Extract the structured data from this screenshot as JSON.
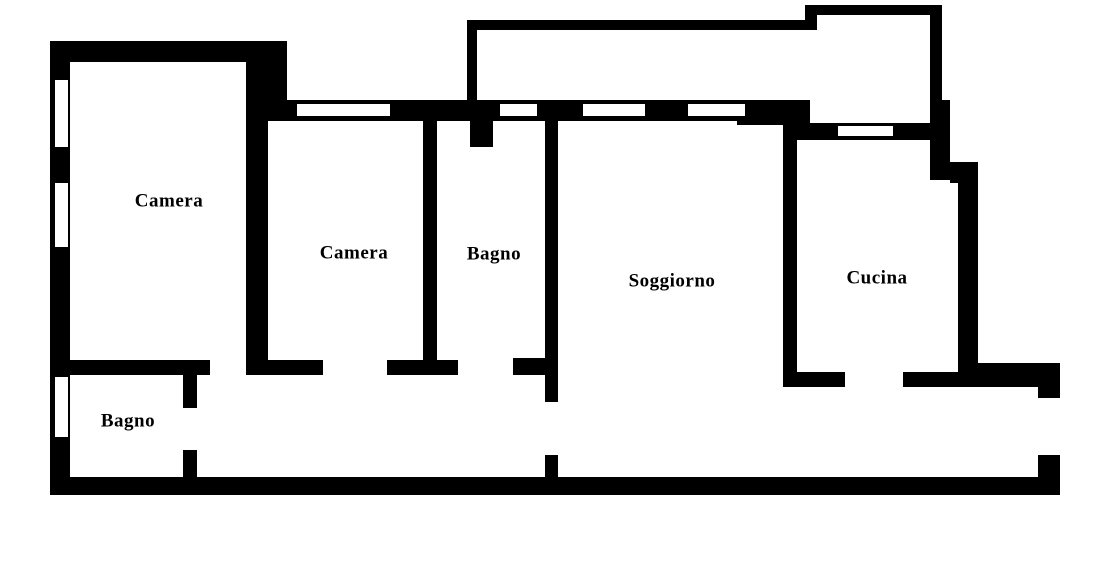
{
  "plan": {
    "title": "Apartment floor plan",
    "width": 1112,
    "height": 561,
    "background_color": "#ffffff",
    "wall_color": "#000000",
    "walls": [
      {
        "name": "exterior-left-wall",
        "x": 50,
        "y": 41,
        "w": 20,
        "h": 454
      },
      {
        "name": "camera1-top-wall",
        "x": 50,
        "y": 41,
        "w": 218,
        "h": 21
      },
      {
        "name": "camera1-top-right-corner-block",
        "x": 258,
        "y": 41,
        "w": 29,
        "h": 80
      },
      {
        "name": "wall-camera1-camera2",
        "x": 246,
        "y": 41,
        "w": 22,
        "h": 334
      },
      {
        "name": "north-window-band",
        "x": 268,
        "y": 100,
        "w": 542,
        "h": 21
      },
      {
        "name": "north-band-thick-block",
        "x": 737,
        "y": 100,
        "w": 73,
        "h": 25
      },
      {
        "name": "balcony-left-wall",
        "x": 467,
        "y": 20,
        "w": 10,
        "h": 81
      },
      {
        "name": "balcony-top-wall",
        "x": 467,
        "y": 20,
        "w": 350,
        "h": 10
      },
      {
        "name": "balcony-box-left-wall",
        "x": 805,
        "y": 5,
        "w": 12,
        "h": 25
      },
      {
        "name": "balcony-box-top-wall",
        "x": 805,
        "y": 5,
        "w": 137,
        "h": 10
      },
      {
        "name": "balcony-box-right-wall",
        "x": 930,
        "y": 5,
        "w": 12,
        "h": 96
      },
      {
        "name": "exterior-right-wall-upper",
        "x": 930,
        "y": 100,
        "w": 20,
        "h": 80
      },
      {
        "name": "exterior-right-step-block",
        "x": 950,
        "y": 162,
        "w": 28,
        "h": 21
      },
      {
        "name": "exterior-right-wall-lower",
        "x": 958,
        "y": 162,
        "w": 20,
        "h": 225
      },
      {
        "name": "cucina-top-wall",
        "x": 797,
        "y": 123,
        "w": 138,
        "h": 17
      },
      {
        "name": "wall-soggiorno-cucina",
        "x": 783,
        "y": 110,
        "w": 14,
        "h": 277
      },
      {
        "name": "cucina-bottom-wall-left-seg",
        "x": 783,
        "y": 372,
        "w": 62,
        "h": 15
      },
      {
        "name": "cucina-bottom-wall-right-seg",
        "x": 903,
        "y": 372,
        "w": 75,
        "h": 15
      },
      {
        "name": "southeast-band",
        "x": 978,
        "y": 363,
        "w": 82,
        "h": 24
      },
      {
        "name": "east-lower-wall-upper-seg",
        "x": 1038,
        "y": 363,
        "w": 22,
        "h": 35
      },
      {
        "name": "east-lower-wall-lower-seg",
        "x": 1038,
        "y": 455,
        "w": 22,
        "h": 40
      },
      {
        "name": "exterior-bottom-wall",
        "x": 50,
        "y": 477,
        "w": 1010,
        "h": 18
      },
      {
        "name": "wall-camera2-bagno",
        "x": 423,
        "y": 121,
        "w": 14,
        "h": 254
      },
      {
        "name": "wall-bagno-soggiorno",
        "x": 545,
        "y": 121,
        "w": 13,
        "h": 281
      },
      {
        "name": "wall-bagno-soggiorno-lower-seg",
        "x": 545,
        "y": 455,
        "w": 13,
        "h": 25
      },
      {
        "name": "bagno-door-jamb-stub",
        "x": 470,
        "y": 121,
        "w": 23,
        "h": 26
      },
      {
        "name": "south-wall-seg-camera1",
        "x": 50,
        "y": 360,
        "w": 160,
        "h": 15
      },
      {
        "name": "south-wall-seg-camera2-left",
        "x": 248,
        "y": 360,
        "w": 75,
        "h": 15
      },
      {
        "name": "south-wall-seg-camera2-right",
        "x": 387,
        "y": 360,
        "w": 71,
        "h": 15
      },
      {
        "name": "south-wall-seg-bagno-stub",
        "x": 513,
        "y": 358,
        "w": 32,
        "h": 17
      },
      {
        "name": "bagno2-right-wall-upper-seg",
        "x": 183,
        "y": 375,
        "w": 14,
        "h": 33
      },
      {
        "name": "bagno2-right-wall-lower-seg",
        "x": 183,
        "y": 450,
        "w": 14,
        "h": 27
      }
    ],
    "windows": [
      {
        "name": "window-left-wall-upper",
        "x": 55,
        "y": 80,
        "w": 13,
        "h": 67
      },
      {
        "name": "window-left-wall-middle",
        "x": 55,
        "y": 183,
        "w": 13,
        "h": 64
      },
      {
        "name": "window-left-wall-bagno2",
        "x": 55,
        "y": 377,
        "w": 13,
        "h": 60
      },
      {
        "name": "window-band-camera2",
        "x": 297,
        "y": 104,
        "w": 93,
        "h": 12
      },
      {
        "name": "window-band-bagno",
        "x": 500,
        "y": 104,
        "w": 37,
        "h": 12
      },
      {
        "name": "window-band-soggiorno-1",
        "x": 583,
        "y": 104,
        "w": 62,
        "h": 12
      },
      {
        "name": "window-band-soggiorno-2",
        "x": 688,
        "y": 104,
        "w": 57,
        "h": 12
      },
      {
        "name": "window-cucina-top-wall",
        "x": 838,
        "y": 126,
        "w": 55,
        "h": 10
      }
    ]
  },
  "rooms": [
    {
      "id": "camera-1",
      "label": "Camera",
      "cx": 169,
      "cy": 201
    },
    {
      "id": "camera-2",
      "label": "Camera",
      "cx": 354,
      "cy": 253
    },
    {
      "id": "bagno-1",
      "label": "Bagno",
      "cx": 494,
      "cy": 254
    },
    {
      "id": "soggiorno",
      "label": "Soggiorno",
      "cx": 672,
      "cy": 281
    },
    {
      "id": "cucina",
      "label": "Cucina",
      "cx": 877,
      "cy": 278
    },
    {
      "id": "bagno-2",
      "label": "Bagno",
      "cx": 128,
      "cy": 421
    }
  ]
}
